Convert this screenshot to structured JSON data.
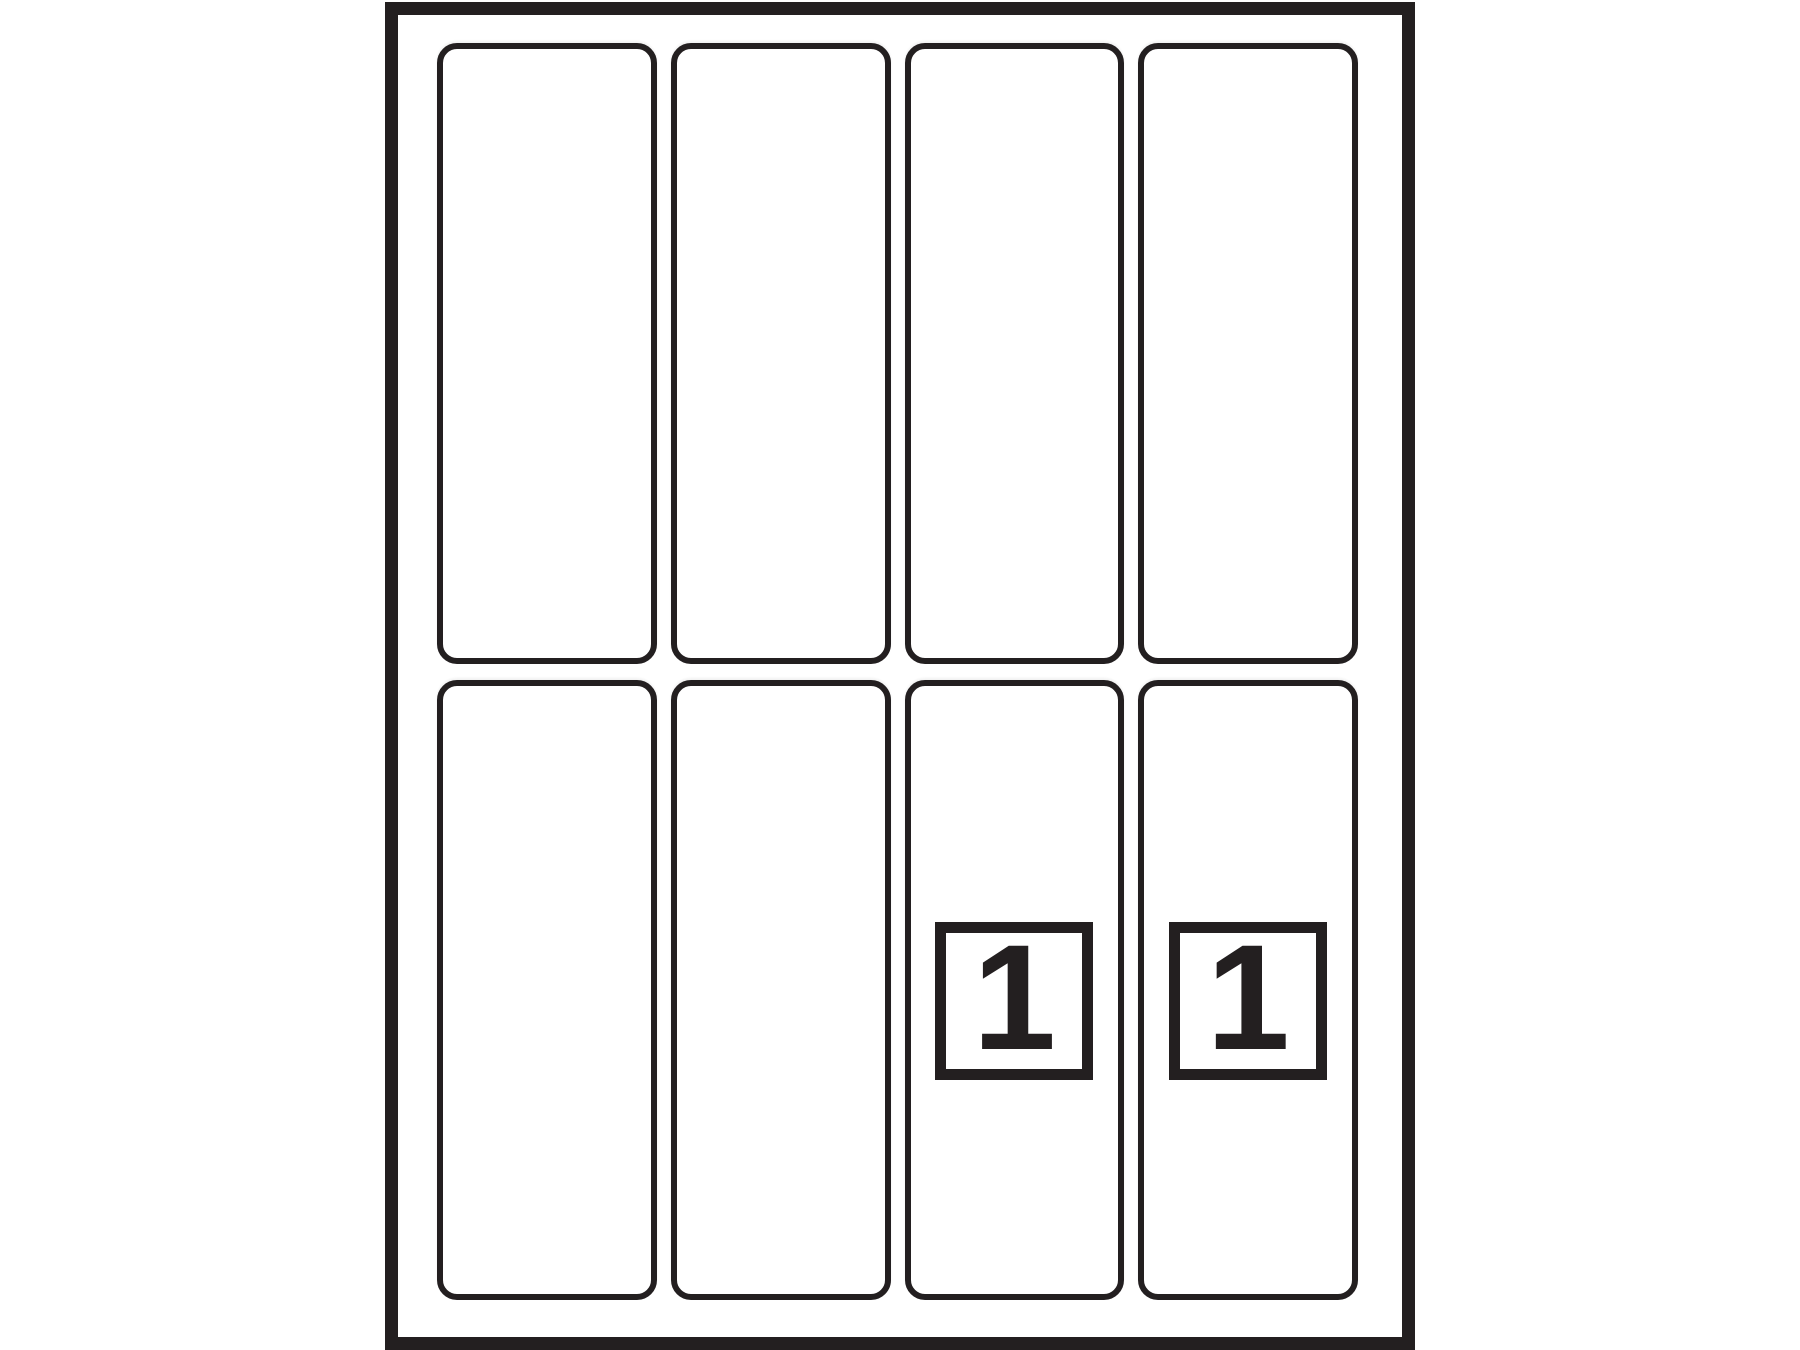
{
  "colors": {
    "ink": "#231f20",
    "paper": "#ffffff"
  },
  "sheet": {
    "grid": {
      "columns": 4,
      "rows": 2,
      "label_count": 8
    },
    "cells": [
      {
        "row": 1,
        "col": 1
      },
      {
        "row": 1,
        "col": 2
      },
      {
        "row": 1,
        "col": 3
      },
      {
        "row": 1,
        "col": 4
      },
      {
        "row": 2,
        "col": 1
      },
      {
        "row": 2,
        "col": 2
      },
      {
        "row": 2,
        "col": 3,
        "badge": "1"
      },
      {
        "row": 2,
        "col": 4,
        "badge": "1"
      }
    ]
  }
}
